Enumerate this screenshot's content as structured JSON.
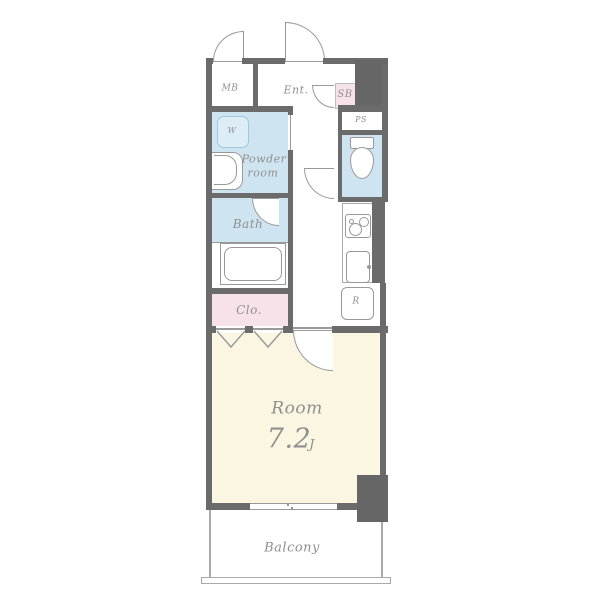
{
  "floorplan": {
    "rooms": {
      "meter_box": "MB",
      "entrance": "Ent.",
      "shoe_box": "SB",
      "pipe_space": "PS",
      "washer": "W",
      "powder_room_line1": "Powder",
      "powder_room_line2": "room",
      "bath": "Bath",
      "closet": "Clo.",
      "refrigerator_space": "R",
      "main_room": "Room",
      "main_room_size": "7.2",
      "main_room_size_unit": "J",
      "balcony": "Balcony"
    },
    "fixtures": [
      "toilet",
      "bathtub",
      "washbasin",
      "washing-machine-space",
      "stove",
      "kitchen-sink",
      "refrigerator-space"
    ],
    "colors": {
      "wall": "#6b6b6b",
      "pillar": "#666666",
      "wet_area_fill": "#cfe4f1",
      "storage_fill": "#f8e2ea",
      "room_fill": "#faf6e2",
      "washer_fill": "#ddedf7",
      "washer_border": "#a4c6dc",
      "line": "#999999",
      "label_text": "#8f8f8f"
    }
  }
}
